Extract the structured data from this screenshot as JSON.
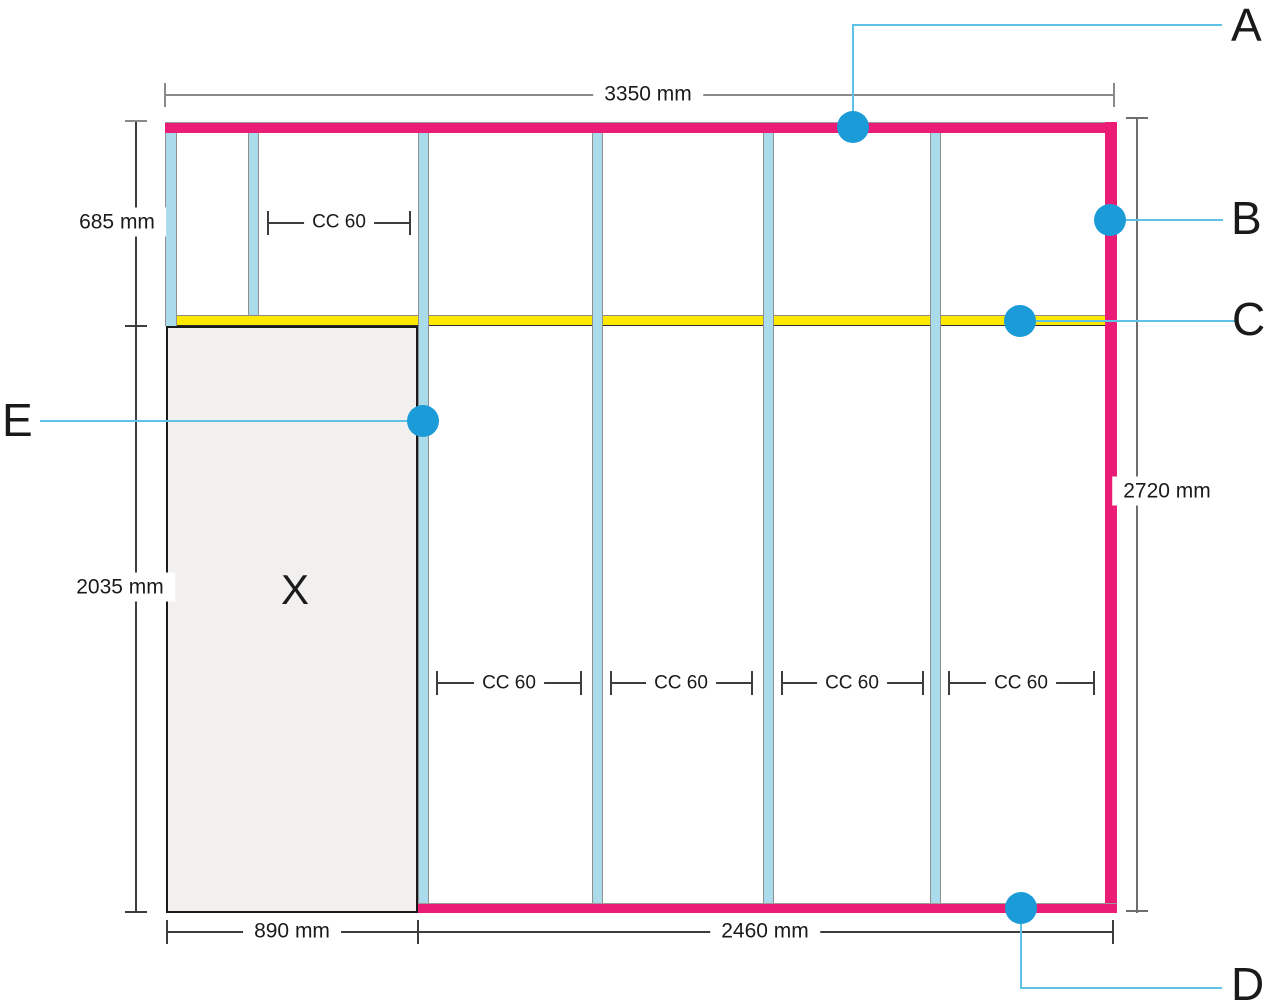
{
  "dimensions": {
    "top": "3350 mm",
    "upper_left": "685 mm",
    "lower_left": "2035 mm",
    "right": "2720 mm",
    "bottom_left": "890 mm",
    "bottom_right": "2460 mm",
    "cc_spacing": "CC 60"
  },
  "region_label": "X",
  "callouts": {
    "a": "A",
    "b": "B",
    "c": "C",
    "d": "D",
    "e": "E"
  },
  "colors": {
    "frame_pink": "#EB1C75",
    "stud_blue": "#A9DBEA",
    "rail_yellow": "#FFE800",
    "opening_gray": "#F1F0EE",
    "callout_marker_blue": "#1B9CD8",
    "callout_line_blue": "#5FC2E5",
    "dimension_line_gray": "#3d3d3d",
    "text_color": "#1a1a1a"
  }
}
